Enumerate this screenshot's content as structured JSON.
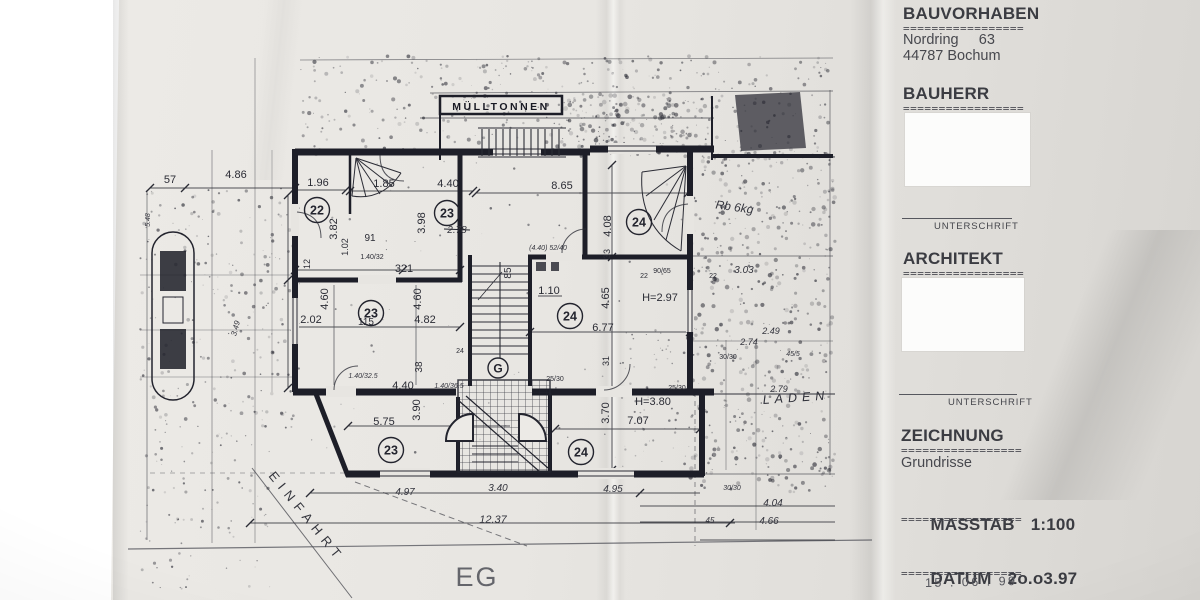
{
  "ink_color": "#23242e",
  "paper_color": "#e7e5e1",
  "title_block": {
    "divider": "=================",
    "bauvorhaben_label": "BAUVORHABEN",
    "address_line1": "Nordring     63",
    "address_line2": "44787 Bochum",
    "bauherr_label": "BAUHERR",
    "unterschrift_label": "UNTERSCHRIFT",
    "architekt_label": "ARCHITEKT",
    "zeichnung_label": "ZEICHNUNG",
    "zeichnung_value": "Grundrisse",
    "masstab_label": "MASSTAB",
    "masstab_value": "1:100",
    "datum_label": "DATUM",
    "datum_value": "2o.o3.97",
    "datum_handwritten": "15 . 06 . 99"
  },
  "plan": {
    "floor_label": "EG",
    "annotations": {
      "muelltonnen": "MÜLLTONNEN",
      "einfahrt": "EINFAHRT",
      "laden": "LADEN"
    },
    "room_circles": [
      {
        "x": 317,
        "y": 210,
        "label": "22"
      },
      {
        "x": 447,
        "y": 213,
        "label": "23"
      },
      {
        "x": 639,
        "y": 222,
        "label": "24"
      },
      {
        "x": 371,
        "y": 313,
        "label": "23"
      },
      {
        "x": 570,
        "y": 316,
        "label": "24"
      },
      {
        "x": 391,
        "y": 450,
        "label": "23"
      },
      {
        "x": 581,
        "y": 452,
        "label": "24"
      }
    ],
    "g_circle": {
      "x": 498,
      "y": 368,
      "label": "G"
    },
    "dimension_labels": [
      {
        "t": "57",
        "x": 170,
        "y": 183
      },
      {
        "t": "4.86",
        "x": 236,
        "y": 178
      },
      {
        "t": "1.96",
        "x": 318,
        "y": 186
      },
      {
        "t": "1.85",
        "x": 384,
        "y": 187
      },
      {
        "t": "4.40",
        "x": 448,
        "y": 187
      },
      {
        "t": "8.65",
        "x": 562,
        "y": 189
      },
      {
        "t": "3.82",
        "x": 337,
        "y": 229,
        "r": -90
      },
      {
        "t": "1.02",
        "x": 348,
        "y": 247,
        "r": -90,
        "s": 9
      },
      {
        "t": "91",
        "x": 370,
        "y": 241,
        "s": 10
      },
      {
        "t": "3.98",
        "x": 425,
        "y": 223,
        "r": -90
      },
      {
        "t": "2.78",
        "x": 457,
        "y": 233,
        "hw": true,
        "strike": true,
        "s": 10
      },
      {
        "t": "4.08",
        "x": 611,
        "y": 226,
        "r": -90
      },
      {
        "t": "33",
        "x": 610,
        "y": 254,
        "r": -90,
        "s": 9
      },
      {
        "t": "(4.40) 52/40",
        "x": 548,
        "y": 250,
        "s": 7,
        "hw": true
      },
      {
        "t": "90/65",
        "x": 662,
        "y": 273,
        "s": 7
      },
      {
        "t": "22",
        "x": 644,
        "y": 278,
        "s": 7
      },
      {
        "t": "12",
        "x": 310,
        "y": 264,
        "r": -90,
        "s": 9
      },
      {
        "t": "1.40/32",
        "x": 372,
        "y": 259,
        "s": 7
      },
      {
        "t": "321",
        "x": 404,
        "y": 272
      },
      {
        "t": "4.60",
        "x": 328,
        "y": 299,
        "r": -90
      },
      {
        "t": "4.60",
        "x": 421,
        "y": 299,
        "r": -90
      },
      {
        "t": "2.02",
        "x": 311,
        "y": 323
      },
      {
        "t": "115",
        "x": 366,
        "y": 325,
        "s": 10
      },
      {
        "t": "4.82",
        "x": 425,
        "y": 323
      },
      {
        "t": "38",
        "x": 422,
        "y": 367,
        "r": -90,
        "s": 10
      },
      {
        "t": "24",
        "x": 460,
        "y": 353,
        "s": 7
      },
      {
        "t": "1.40/32.5",
        "x": 363,
        "y": 378,
        "s": 7,
        "hw": true
      },
      {
        "t": "4.40",
        "x": 403,
        "y": 389
      },
      {
        "t": "1.40/36.5",
        "x": 449,
        "y": 388,
        "s": 7,
        "hw": true
      },
      {
        "t": "85",
        "x": 511,
        "y": 273,
        "r": -90,
        "s": 10
      },
      {
        "t": "1.10",
        "x": 549,
        "y": 294
      },
      {
        "t": "4.65",
        "x": 609,
        "y": 298,
        "r": -90
      },
      {
        "t": "6.77",
        "x": 603,
        "y": 331
      },
      {
        "t": "H=2.97",
        "x": 660,
        "y": 301
      },
      {
        "t": "31",
        "x": 609,
        "y": 361,
        "r": -90,
        "s": 9
      },
      {
        "t": "25/30",
        "x": 555,
        "y": 381,
        "s": 7
      },
      {
        "t": "25/30",
        "x": 677,
        "y": 390,
        "s": 7
      },
      {
        "t": "5.75",
        "x": 384,
        "y": 425
      },
      {
        "t": "3.90",
        "x": 420,
        "y": 410,
        "r": -90
      },
      {
        "t": "H=3.80",
        "x": 653,
        "y": 405
      },
      {
        "t": "7.07",
        "x": 638,
        "y": 424
      },
      {
        "t": "3.70",
        "x": 609,
        "y": 413,
        "r": -90
      },
      {
        "t": "3.40",
        "x": 498,
        "y": 491,
        "hw": true,
        "s": 10
      },
      {
        "t": "4.97",
        "x": 405,
        "y": 495,
        "hw": true,
        "s": 10
      },
      {
        "t": "4.95",
        "x": 613,
        "y": 492,
        "hw": true,
        "s": 10
      },
      {
        "t": "12.37",
        "x": 493,
        "y": 523,
        "hw": true
      },
      {
        "t": "Rb 6kg",
        "x": 734,
        "y": 211,
        "hw": true,
        "r": 8,
        "s": 12
      },
      {
        "t": "3.03",
        "x": 744,
        "y": 273,
        "hw": true,
        "s": 10
      },
      {
        "t": "22",
        "x": 713,
        "y": 278,
        "s": 7
      },
      {
        "t": "2.49",
        "x": 771,
        "y": 334,
        "hw": true,
        "s": 9
      },
      {
        "t": "2.74",
        "x": 749,
        "y": 345,
        "hw": true,
        "s": 9
      },
      {
        "t": "30/30",
        "x": 728,
        "y": 359,
        "s": 7
      },
      {
        "t": "45/5",
        "x": 793,
        "y": 356,
        "s": 7,
        "hw": true
      },
      {
        "t": "2.79",
        "x": 779,
        "y": 392,
        "hw": true,
        "s": 9
      },
      {
        "t": "30/30",
        "x": 732,
        "y": 490,
        "s": 7,
        "hw": true
      },
      {
        "t": "4.04",
        "x": 773,
        "y": 506,
        "hw": true,
        "s": 10
      },
      {
        "t": "4.66",
        "x": 769,
        "y": 524,
        "hw": true,
        "s": 10
      },
      {
        "t": "45",
        "x": 710,
        "y": 523,
        "s": 8,
        "hw": true
      },
      {
        "t": "3.49",
        "x": 238,
        "y": 329,
        "r": -75,
        "hw": true,
        "s": 8
      },
      {
        "t": "5.48",
        "x": 150,
        "y": 220,
        "r": -90,
        "s": 7,
        "hw": true
      }
    ]
  }
}
